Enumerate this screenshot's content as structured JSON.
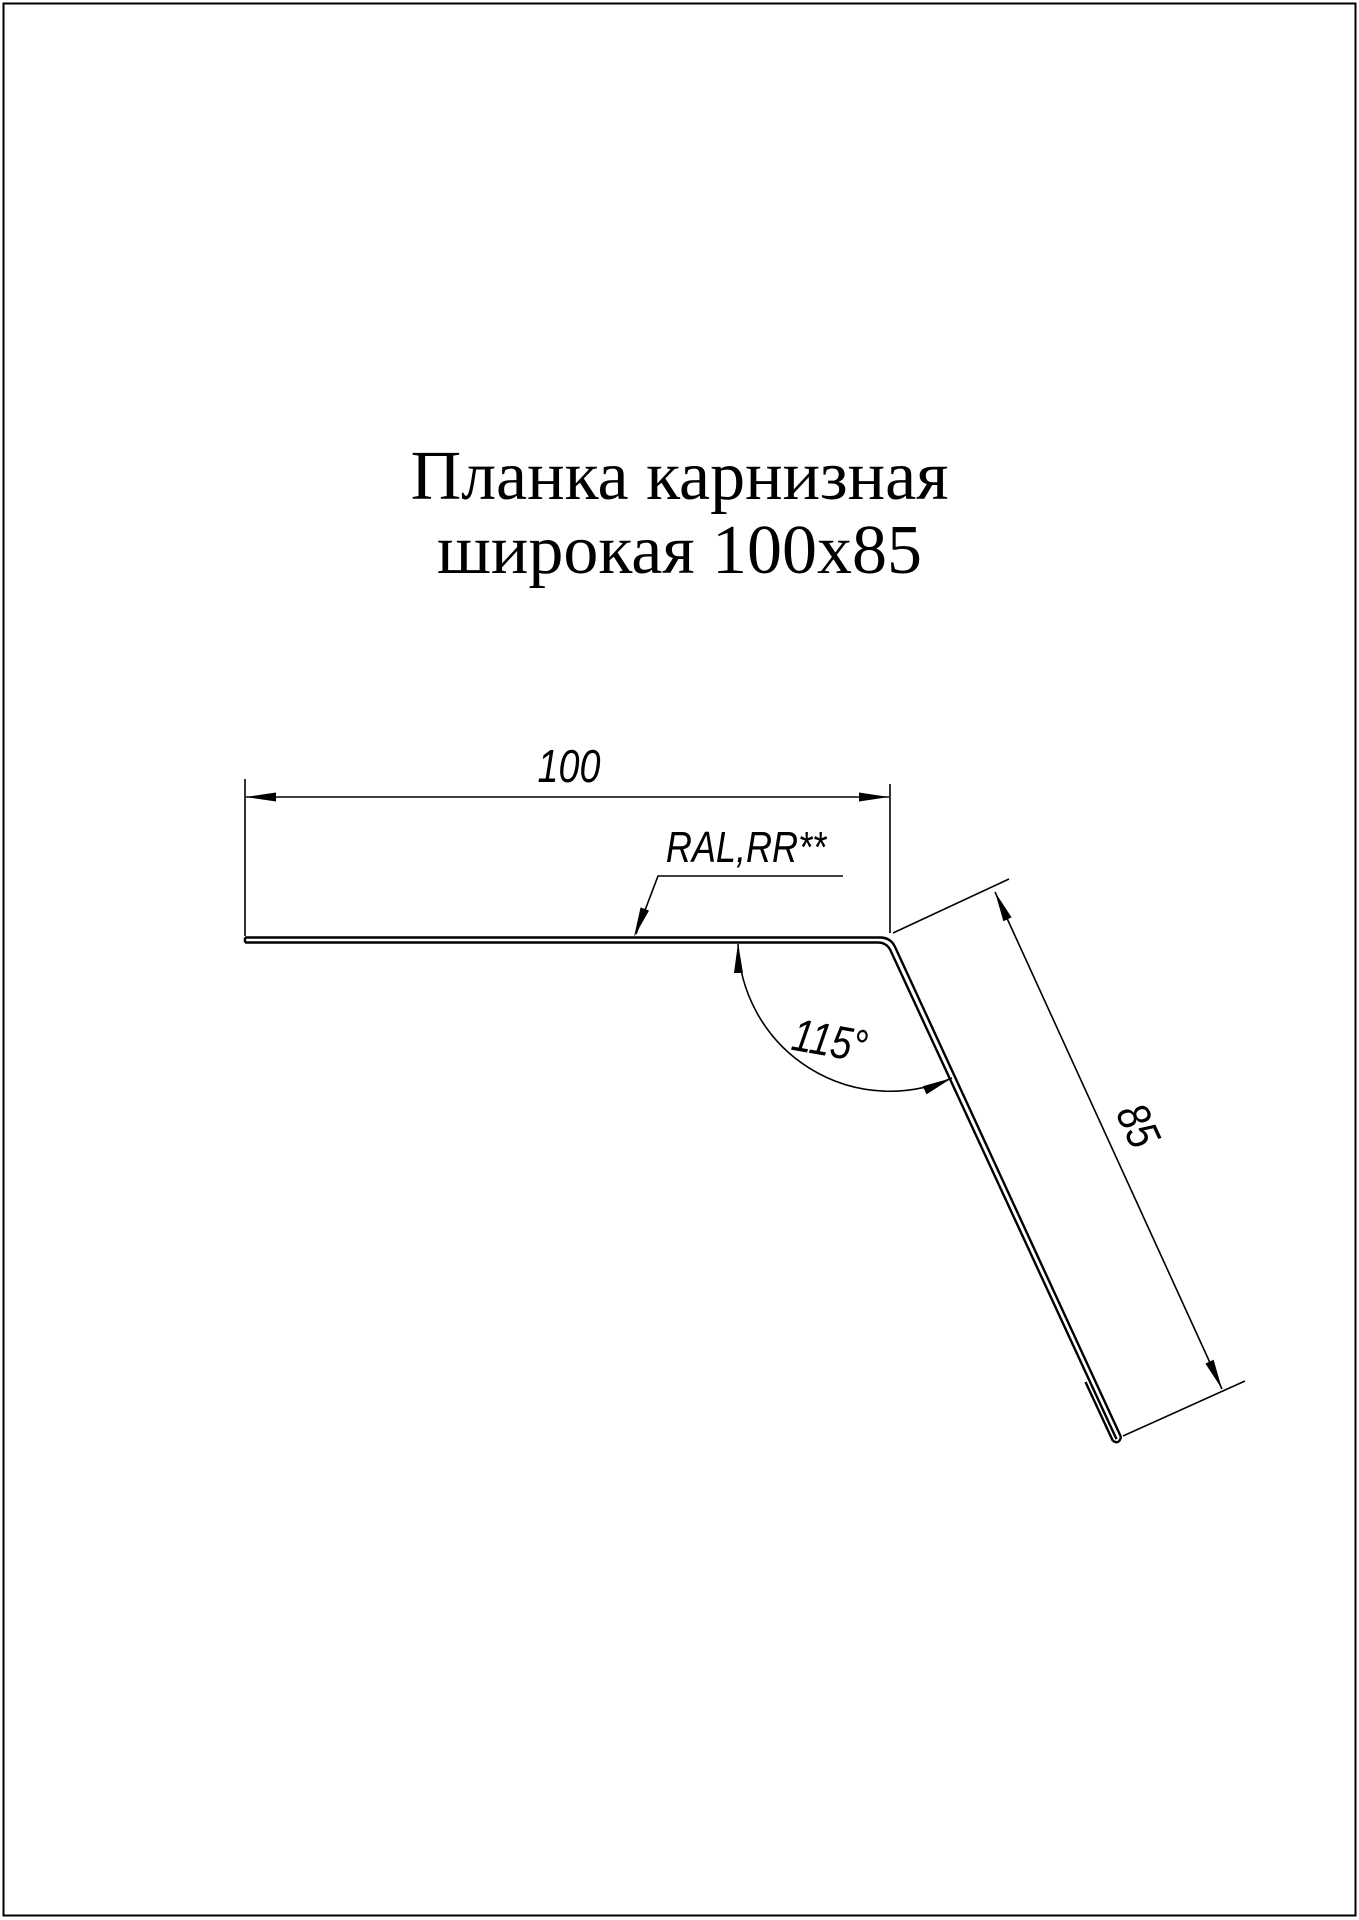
{
  "page": {
    "title_line1": "Планка карнизная",
    "title_line2": "широкая 100x85",
    "background_color": "#ffffff",
    "line_color": "#000000"
  },
  "drawing": {
    "dim_width_label": "100",
    "dim_height_label": "85",
    "angle_label": "115°",
    "material_label": "RAL,RR**"
  }
}
